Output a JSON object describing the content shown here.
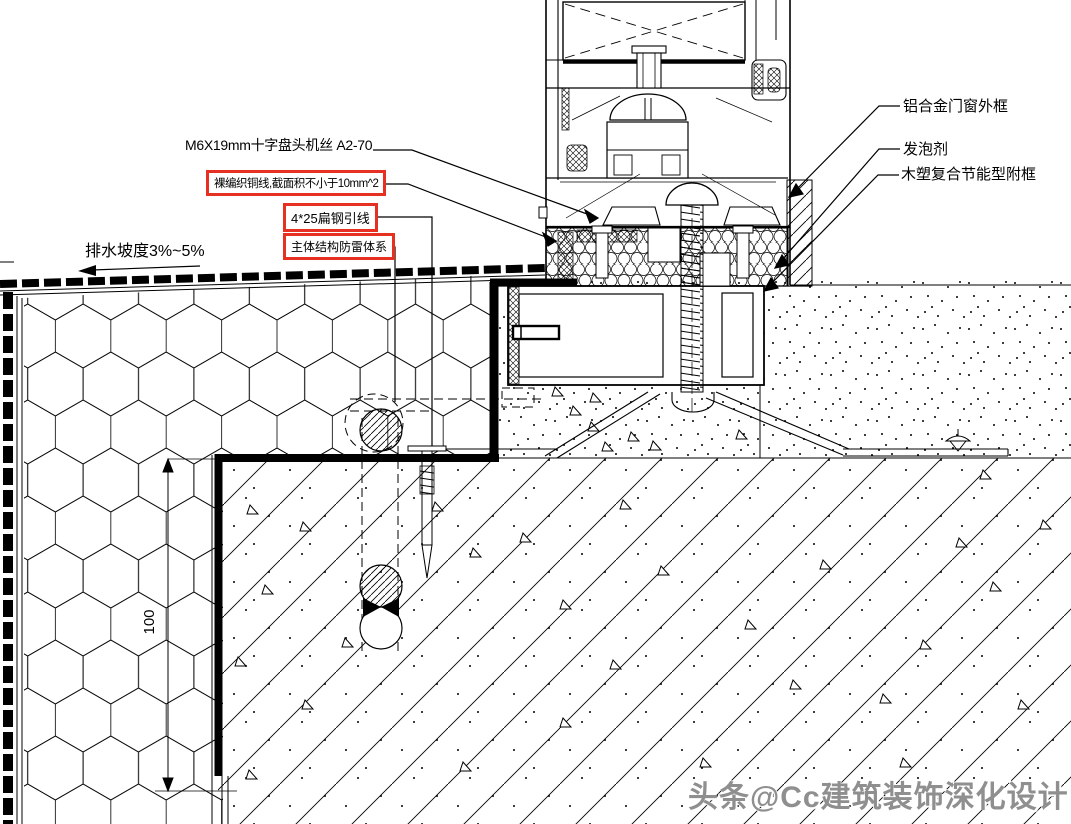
{
  "drawing": {
    "callouts_left": [
      {
        "label": "M6X19mm十字盘头机丝 A2-70",
        "highlighted": false
      },
      {
        "label": "裸编织铜线,截面积不小于10mm^2",
        "highlighted": true
      },
      {
        "label": "4*25扁钢引线",
        "highlighted": true
      },
      {
        "label": "主体结构防雷体系",
        "highlighted": true
      }
    ],
    "callouts_right": [
      {
        "label": "铝合金门窗外框"
      },
      {
        "label": "发泡剂"
      },
      {
        "label": "木塑复合节能型附框"
      }
    ],
    "slope_note": "排水坡度3%~5%",
    "dimension_100": "100",
    "watermark": "头条@Cc建筑装饰深化设计",
    "colors": {
      "highlight_box": "#e53022",
      "line": "#000000",
      "watermark_gray": "#8f8f8f",
      "paper": "#ffffff"
    }
  }
}
